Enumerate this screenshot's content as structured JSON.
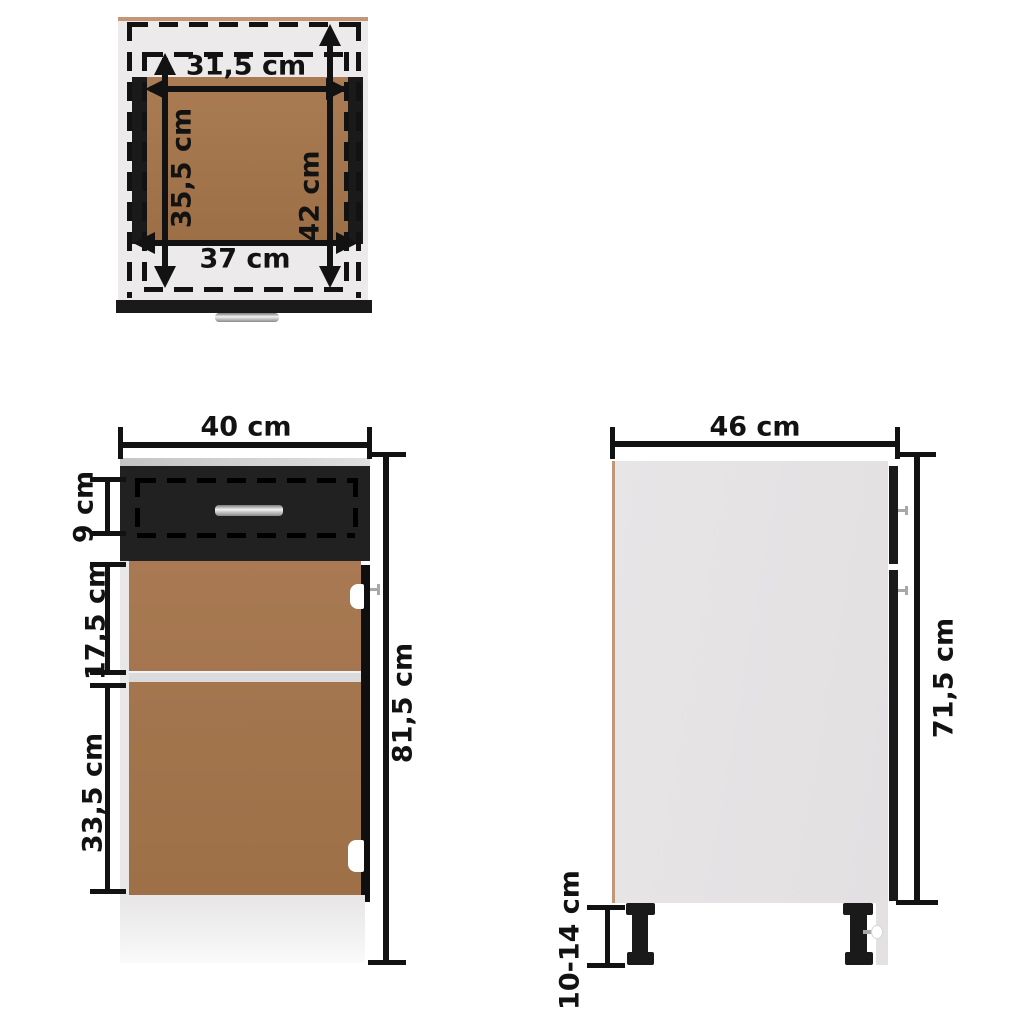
{
  "unit": "cm",
  "colors": {
    "ink": "#121212",
    "wood": "#a5764d",
    "wood_top": "#a87a51",
    "panel": "#e5e3e4",
    "panel_light": "#eceaeb",
    "edge_tan": "#c49678",
    "bg": "#ffffff"
  },
  "top_view": {
    "labels": {
      "inner_width": "31,5 cm",
      "inner_depth": "35,5 cm",
      "rail_depth": "42 cm",
      "outer_width": "37 cm"
    }
  },
  "front_view": {
    "labels": {
      "width": "40 cm",
      "drawer_height": "9 cm",
      "upper_section_height": "17,5 cm",
      "lower_section_height": "33,5 cm",
      "total_height": "81,5 cm"
    }
  },
  "side_view": {
    "labels": {
      "depth": "46 cm",
      "body_height": "71,5 cm",
      "leg_height": "10-14 cm"
    }
  }
}
